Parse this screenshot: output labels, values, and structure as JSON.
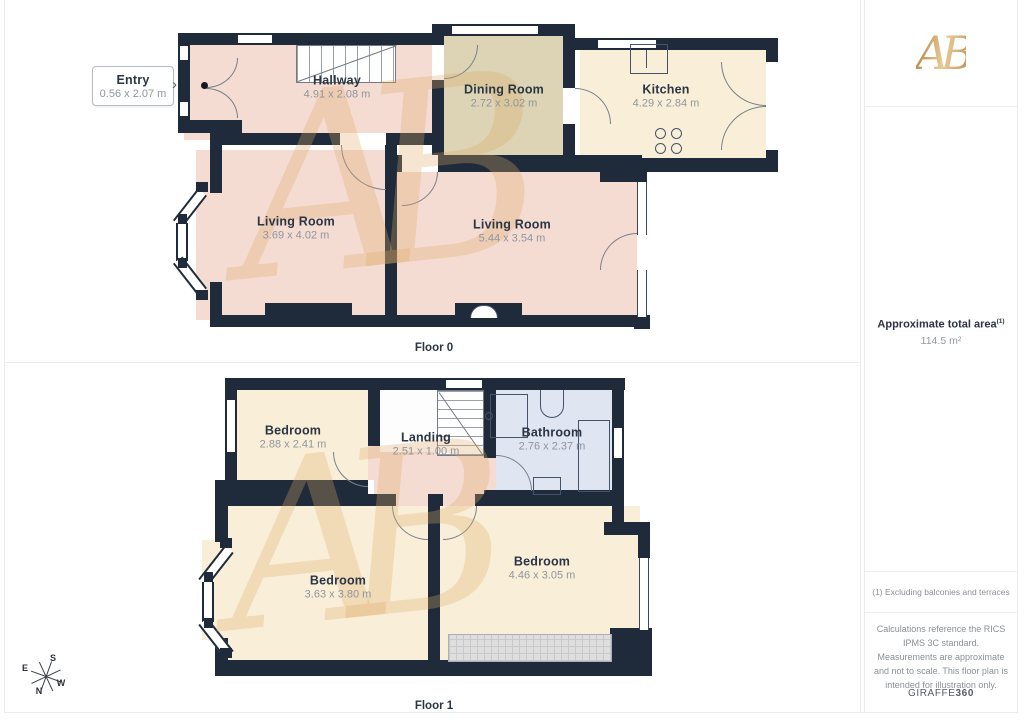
{
  "floor0": {
    "label": "Floor 0",
    "entry": {
      "name": "Entry",
      "dims": "0.56 x 2.07 m"
    },
    "rooms": [
      {
        "name": "Hallway",
        "dims": "4.91 x 2.08 m"
      },
      {
        "name": "Dining Room",
        "dims": "2.72 x 3.02 m"
      },
      {
        "name": "Kitchen",
        "dims": "4.29 x 2.84 m"
      },
      {
        "name": "Living Room",
        "dims": "3.69 x 4.02 m"
      },
      {
        "name": "Living Room",
        "dims": "5.44 x 3.54 m"
      }
    ]
  },
  "floor1": {
    "label": "Floor 1",
    "rooms": [
      {
        "name": "Bedroom",
        "dims": "2.88 x 2.41 m"
      },
      {
        "name": "Landing",
        "dims": "2.51 x 1.00 m"
      },
      {
        "name": "Bathroom",
        "dims": "2.76 x 2.37 m"
      },
      {
        "name": "Bedroom",
        "dims": "3.63 x 3.80 m"
      },
      {
        "name": "Bedroom",
        "dims": "4.46 x 3.05 m"
      }
    ]
  },
  "compass": {
    "n": "N",
    "s": "S",
    "e": "E",
    "w": "W"
  },
  "watermark": {
    "text": "AB"
  },
  "sidebar": {
    "logo_text": "AB",
    "area_label": "Approximate total area",
    "area_sup": "(1)",
    "area_value": "114.5 m²",
    "footnote": "(1) Excluding balconies and terraces",
    "disclaimer": "Calculations reference the RICS IPMS 3C standard. Measurements are approximate and not to scale. This floor plan is intended for illustration only.",
    "brand_regular": "GIRAFFE",
    "brand_bold": "360"
  },
  "colors": {
    "wall": "#1f2b3a",
    "room_pink": "#f5dcd2",
    "room_cream": "#f9efd8",
    "room_beige": "#dcd4b4",
    "room_blue": "#dfe5f1",
    "brand_gold": "#c89a62"
  }
}
